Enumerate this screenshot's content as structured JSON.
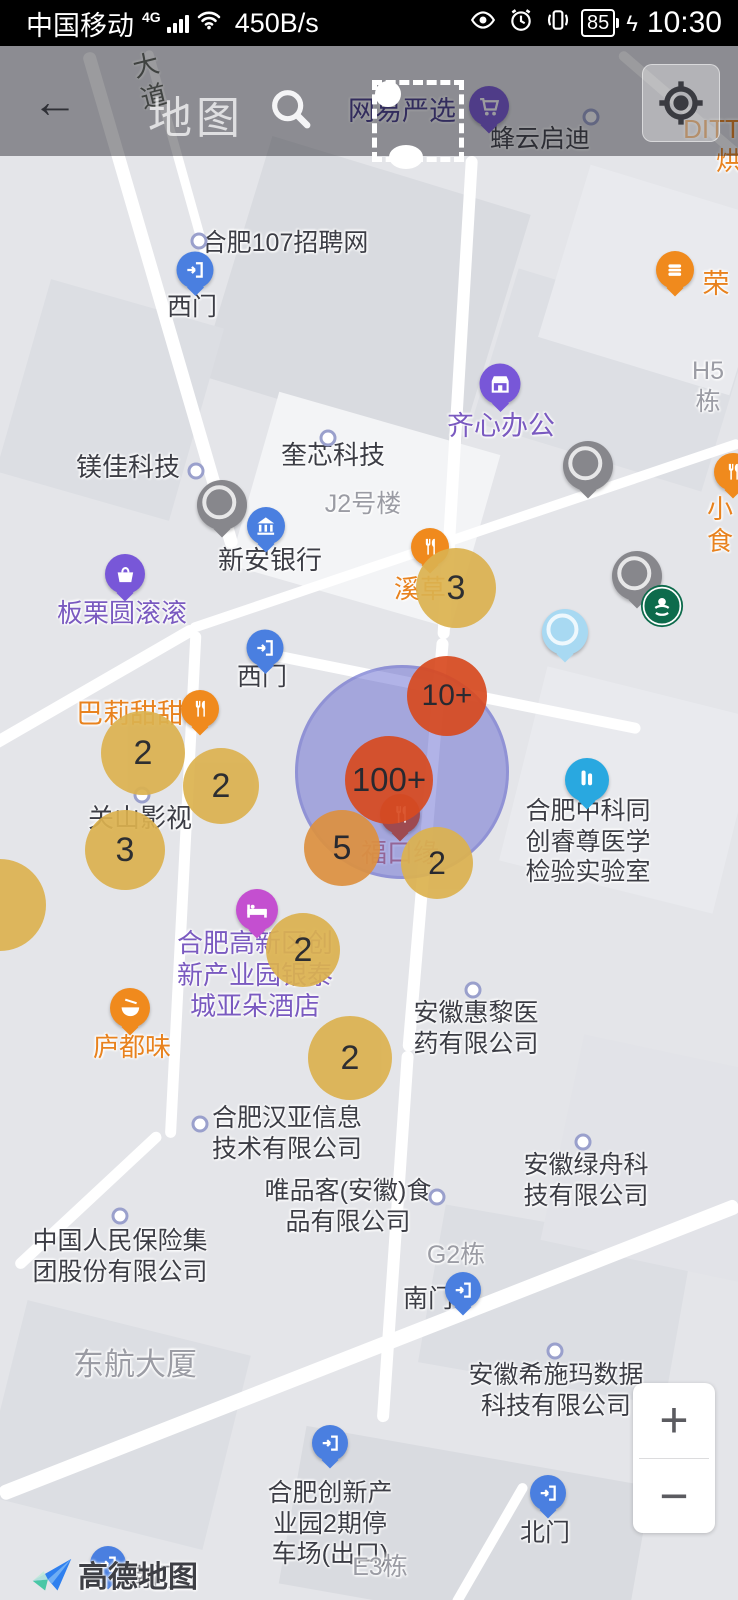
{
  "status_bar": {
    "carrier": "中国移动",
    "network": "4G",
    "speed": "450B/s",
    "battery": "85",
    "charge_bolt": "ϟ",
    "time": "10:30"
  },
  "header": {
    "title": "地图",
    "back_glyph": "←"
  },
  "colors": {
    "company": "#3c3d45",
    "building": "#9b9ca4",
    "purple": "#7a5ac0",
    "orange": "#e8821e",
    "indigo": "#443a8c",
    "redlabel": "#c4625c",
    "road": "#5c6158",
    "yellow_cluster": "#dcb24f",
    "orange_cluster": "#dd9140",
    "red_cluster": "#d84a20",
    "heat_fill": "rgba(100,103,208,0.5)"
  },
  "map": {
    "labels": [
      {
        "nm": "road-label-dadao",
        "t": "大\n道",
        "x": 150,
        "y": 50,
        "c": "road",
        "s": 26,
        "rot": -14,
        "it": false
      },
      {
        "nm": "poi-label-wangyiyanxuan",
        "t": "网易严选",
        "x": 402,
        "y": 95,
        "c": "indigo",
        "s": 27,
        "it": true
      },
      {
        "nm": "poi-label-fengyunqidi",
        "t": "蜂云启迪",
        "x": 540,
        "y": 124,
        "c": "company",
        "s": 25,
        "it": true
      },
      {
        "nm": "poi-label-ditt",
        "t": "DITT",
        "x": 712,
        "y": 114,
        "c": "orange",
        "s": 26,
        "it": true
      },
      {
        "nm": "poi-label-hong",
        "t": "烘",
        "x": 729,
        "y": 146,
        "c": "orange",
        "s": 26,
        "it": true
      },
      {
        "nm": "poi-label-hefei107",
        "t": "合肥107招聘网",
        "x": 285,
        "y": 228,
        "c": "company",
        "s": 25,
        "it": true
      },
      {
        "nm": "poi-label-ximen-top",
        "t": "西门",
        "x": 192,
        "y": 292,
        "c": "company",
        "s": 25,
        "it": true
      },
      {
        "nm": "poi-label-rong",
        "t": "荣",
        "x": 716,
        "y": 268,
        "c": "orange",
        "s": 27,
        "it": true
      },
      {
        "nm": "building-label-h5",
        "t": "H5栋",
        "x": 708,
        "y": 356,
        "c": "building",
        "s": 25,
        "it": false
      },
      {
        "nm": "poi-label-qixinbangong",
        "t": "齐心办公",
        "x": 501,
        "y": 410,
        "c": "purple",
        "s": 27,
        "it": true
      },
      {
        "nm": "poi-label-kuixinkeji",
        "t": "奎芯科技",
        "x": 333,
        "y": 440,
        "c": "company",
        "s": 26,
        "it": true
      },
      {
        "nm": "poi-label-meijiakeji",
        "t": "镁佳科技",
        "x": 128,
        "y": 452,
        "c": "company",
        "s": 26,
        "it": true
      },
      {
        "nm": "building-label-j2",
        "t": "J2号楼",
        "x": 363,
        "y": 489,
        "c": "building",
        "s": 25,
        "it": false
      },
      {
        "nm": "poi-label-xinanyinhang",
        "t": "新安银行",
        "x": 270,
        "y": 545,
        "c": "company",
        "s": 26,
        "it": true
      },
      {
        "nm": "poi-label-xicao",
        "t": "溪草",
        "x": 420,
        "y": 574,
        "c": "orange",
        "s": 26,
        "it": true
      },
      {
        "nm": "poi-label-xiaoshi",
        "t": "小食",
        "x": 720,
        "y": 494,
        "c": "orange",
        "s": 26,
        "it": true
      },
      {
        "nm": "poi-label-banliyuangungun",
        "t": "板栗圆滚滚",
        "x": 122,
        "y": 598,
        "c": "purple",
        "s": 26,
        "it": true
      },
      {
        "nm": "poi-label-ximen-mid",
        "t": "西门",
        "x": 262,
        "y": 662,
        "c": "company",
        "s": 25,
        "it": true
      },
      {
        "nm": "poi-label-balitiantian",
        "t": "巴莉甜甜",
        "x": 130,
        "y": 698,
        "c": "orange",
        "s": 27,
        "it": true
      },
      {
        "nm": "poi-label-guanshanyingshi",
        "t": "关山影视",
        "x": 140,
        "y": 803,
        "c": "company",
        "s": 26,
        "it": true
      },
      {
        "nm": "poi-label-fukouyuan",
        "t": "福口缘",
        "x": 400,
        "y": 838,
        "c": "redlabel",
        "s": 26,
        "it": true
      },
      {
        "nm": "poi-label-zhongketongchuang",
        "t": "合肥中科同\n创睿尊医学\n检验实验室",
        "x": 588,
        "y": 796,
        "c": "company",
        "s": 25,
        "it": true
      },
      {
        "nm": "poi-label-yaduo-hotel",
        "t": "合肥高新区创\n新产业园银泰\n城亚朵酒店",
        "x": 255,
        "y": 928,
        "c": "purple",
        "s": 26,
        "it": true
      },
      {
        "nm": "poi-label-luduwei",
        "t": "庐都味",
        "x": 132,
        "y": 1032,
        "c": "orange",
        "s": 26,
        "it": true
      },
      {
        "nm": "poi-label-huili",
        "t": "安徽惠黎医\n药有限公司",
        "x": 476,
        "y": 998,
        "c": "company",
        "s": 25,
        "it": true
      },
      {
        "nm": "poi-label-hanya",
        "t": "合肥汉亚信息\n技术有限公司",
        "x": 287,
        "y": 1103,
        "c": "company",
        "s": 25,
        "it": true
      },
      {
        "nm": "poi-label-weipinke",
        "t": "唯品客(安徽)食\n品有限公司",
        "x": 348,
        "y": 1176,
        "c": "company",
        "s": 25,
        "it": true
      },
      {
        "nm": "poi-label-renbao",
        "t": "中国人民保险集\n团股份有限公司",
        "x": 120,
        "y": 1226,
        "c": "company",
        "s": 25,
        "it": true
      },
      {
        "nm": "building-label-g2",
        "t": "G2栋",
        "x": 456,
        "y": 1240,
        "c": "building",
        "s": 25,
        "it": false
      },
      {
        "nm": "poi-label-nanmen-mid",
        "t": "南门",
        "x": 428,
        "y": 1284,
        "c": "company",
        "s": 25,
        "it": true
      },
      {
        "nm": "poi-label-lvzhou",
        "t": "安徽绿舟科\n技有限公司",
        "x": 586,
        "y": 1150,
        "c": "company",
        "s": 25,
        "it": true
      },
      {
        "nm": "poi-label-xishima",
        "t": "安徽希施玛数据\n科技有限公司",
        "x": 556,
        "y": 1360,
        "c": "company",
        "s": 25,
        "it": true
      },
      {
        "nm": "building-label-donghang",
        "t": "东航大厦",
        "x": 135,
        "y": 1346,
        "c": "building",
        "s": 31,
        "it": false
      },
      {
        "nm": "poi-label-tingchechang",
        "t": "合肥创新产\n业园2期停\n车场(出口)",
        "x": 330,
        "y": 1478,
        "c": "company",
        "s": 25,
        "it": true
      },
      {
        "nm": "poi-label-beimen",
        "t": "北门",
        "x": 545,
        "y": 1518,
        "c": "company",
        "s": 25,
        "it": true
      },
      {
        "nm": "building-label-e3",
        "t": "E3栋",
        "x": 380,
        "y": 1552,
        "c": "building",
        "s": 25,
        "it": false
      },
      {
        "nm": "poi-label-nanmen-bottom",
        "t": "南门",
        "x": 152,
        "y": 1563,
        "c": "company",
        "s": 25,
        "it": true
      }
    ],
    "dots": [
      {
        "x": 199,
        "y": 241
      },
      {
        "x": 591,
        "y": 117
      },
      {
        "x": 328,
        "y": 438
      },
      {
        "x": 196,
        "y": 471
      },
      {
        "x": 142,
        "y": 795
      },
      {
        "x": 473,
        "y": 990
      },
      {
        "x": 200,
        "y": 1124
      },
      {
        "x": 437,
        "y": 1197
      },
      {
        "x": 120,
        "y": 1216
      },
      {
        "x": 583,
        "y": 1142
      },
      {
        "x": 555,
        "y": 1351
      }
    ],
    "markers": [
      {
        "nm": "marker-cart-wangyiyanxuan",
        "icon": "cart-icon",
        "col": "#7857d8",
        "x": 489,
        "y": 106,
        "s": 40
      },
      {
        "nm": "marker-gate-ximen-top",
        "icon": "gate-icon",
        "col": "#4a7fe0",
        "x": 195,
        "y": 270,
        "s": 37
      },
      {
        "nm": "marker-burger-rong",
        "icon": "burger-icon",
        "col": "#f08a1d",
        "x": 675,
        "y": 270,
        "s": 38
      },
      {
        "nm": "marker-shop-qixinbangong",
        "icon": "shop-icon",
        "col": "#7857d8",
        "x": 500,
        "y": 384,
        "s": 41
      },
      {
        "nm": "marker-gray-pin-1",
        "icon": "lens",
        "col": "#87878c",
        "x": 222,
        "y": 505,
        "s": 50
      },
      {
        "nm": "marker-bank-xinanyinhang",
        "icon": "bank-icon",
        "col": "#4a7fe0",
        "x": 266,
        "y": 526,
        "s": 38
      },
      {
        "nm": "marker-fork-xicao",
        "icon": "fork-knife-icon",
        "col": "#f08a1d",
        "x": 430,
        "y": 547,
        "s": 38
      },
      {
        "nm": "marker-gray-pin-2",
        "icon": "lens",
        "col": "#87878c",
        "x": 588,
        "y": 466,
        "s": 50
      },
      {
        "nm": "marker-orange-edge",
        "icon": "fork-knife-icon",
        "col": "#f08a1d",
        "x": 733,
        "y": 472,
        "s": 38
      },
      {
        "nm": "marker-gray-pin-3",
        "icon": "lens",
        "col": "#87878c",
        "x": 637,
        "y": 576,
        "s": 50
      },
      {
        "nm": "marker-lightblue-pin",
        "icon": "lens",
        "col": "#a8d9f2",
        "x": 565,
        "y": 632,
        "s": 46
      },
      {
        "nm": "marker-basket-banli",
        "icon": "basket-icon",
        "col": "#7857d8",
        "x": 125,
        "y": 574,
        "s": 40
      },
      {
        "nm": "marker-gate-ximen-mid",
        "icon": "gate-icon",
        "col": "#4a7fe0",
        "x": 265,
        "y": 648,
        "s": 37
      },
      {
        "nm": "marker-fork-bali",
        "icon": "fork-knife-icon",
        "col": "#f08a1d",
        "x": 200,
        "y": 709,
        "s": 38
      },
      {
        "nm": "marker-fukouyuan",
        "icon": "fork-knife-icon",
        "col": "#9e4a50",
        "x": 400,
        "y": 814,
        "s": 40,
        "z": 4
      },
      {
        "nm": "marker-flask-zhongke",
        "icon": "flask-icon",
        "col": "#29a8e0",
        "x": 587,
        "y": 780,
        "s": 44
      },
      {
        "nm": "marker-bed-yaduo",
        "icon": "bed-icon",
        "col": "#c44fd0",
        "x": 257,
        "y": 910,
        "s": 42
      },
      {
        "nm": "marker-bowl-luduwei",
        "icon": "bowl-icon",
        "col": "#f08a1d",
        "x": 130,
        "y": 1008,
        "s": 40
      },
      {
        "nm": "marker-gate-nanmen-mid",
        "icon": "gate-icon",
        "col": "#4a7fe0",
        "x": 463,
        "y": 1290,
        "s": 36
      },
      {
        "nm": "marker-gate-tingchechang",
        "icon": "gate-icon",
        "col": "#4a7fe0",
        "x": 330,
        "y": 1443,
        "s": 36
      },
      {
        "nm": "marker-gate-beimen",
        "icon": "gate-icon",
        "col": "#4a7fe0",
        "x": 548,
        "y": 1493,
        "s": 36
      },
      {
        "nm": "marker-gate-nanmen-bottom",
        "icon": "gate-icon",
        "col": "#4a7fe0",
        "x": 108,
        "y": 1564,
        "s": 36
      },
      {
        "nm": "marker-starbucks",
        "icon": "starbucks-icon",
        "col": "#0d6b4c",
        "x": 662,
        "y": 606,
        "s": 46,
        "flat": true
      }
    ],
    "clusters": [
      {
        "nm": "cluster-3-xicao",
        "n": "3",
        "x": 456,
        "y": 588,
        "d": 80,
        "c": "yellow_cluster",
        "fs": 34
      },
      {
        "nm": "cluster-2-bali-left",
        "n": "2",
        "x": 143,
        "y": 753,
        "d": 84,
        "c": "yellow_cluster",
        "fs": 34
      },
      {
        "nm": "cluster-2-bali-right",
        "n": "2",
        "x": 221,
        "y": 786,
        "d": 76,
        "c": "yellow_cluster",
        "fs": 34
      },
      {
        "nm": "cluster-3-guanshan",
        "n": "3",
        "x": 125,
        "y": 850,
        "d": 80,
        "c": "yellow_cluster",
        "fs": 34
      },
      {
        "nm": "cluster-partial-left",
        "n": "",
        "x": 0,
        "y": 905,
        "d": 92,
        "c": "yellow_cluster",
        "fs": 34
      },
      {
        "nm": "cluster-10plus",
        "n": "10+",
        "x": 447,
        "y": 696,
        "d": 80,
        "c": "red_cluster",
        "fs": 30
      },
      {
        "nm": "cluster-100plus",
        "n": "100+",
        "x": 389,
        "y": 780,
        "d": 88,
        "c": "red_cluster",
        "fs": 33
      },
      {
        "nm": "cluster-5",
        "n": "5",
        "x": 342,
        "y": 848,
        "d": 76,
        "c": "orange_cluster",
        "fs": 34
      },
      {
        "nm": "cluster-2-fukou",
        "n": "2",
        "x": 437,
        "y": 863,
        "d": 72,
        "c": "yellow_cluster",
        "fs": 32
      },
      {
        "nm": "cluster-2-yaduo",
        "n": "2",
        "x": 303,
        "y": 950,
        "d": 74,
        "c": "yellow_cluster",
        "fs": 34
      },
      {
        "nm": "cluster-2-hanya",
        "n": "2",
        "x": 350,
        "y": 1058,
        "d": 84,
        "c": "yellow_cluster",
        "fs": 34
      }
    ],
    "heat_circle": {
      "x": 402,
      "y": 772,
      "d": 214
    },
    "zoom_in": "+",
    "zoom_out": "−",
    "logo_text": "高德地图"
  }
}
